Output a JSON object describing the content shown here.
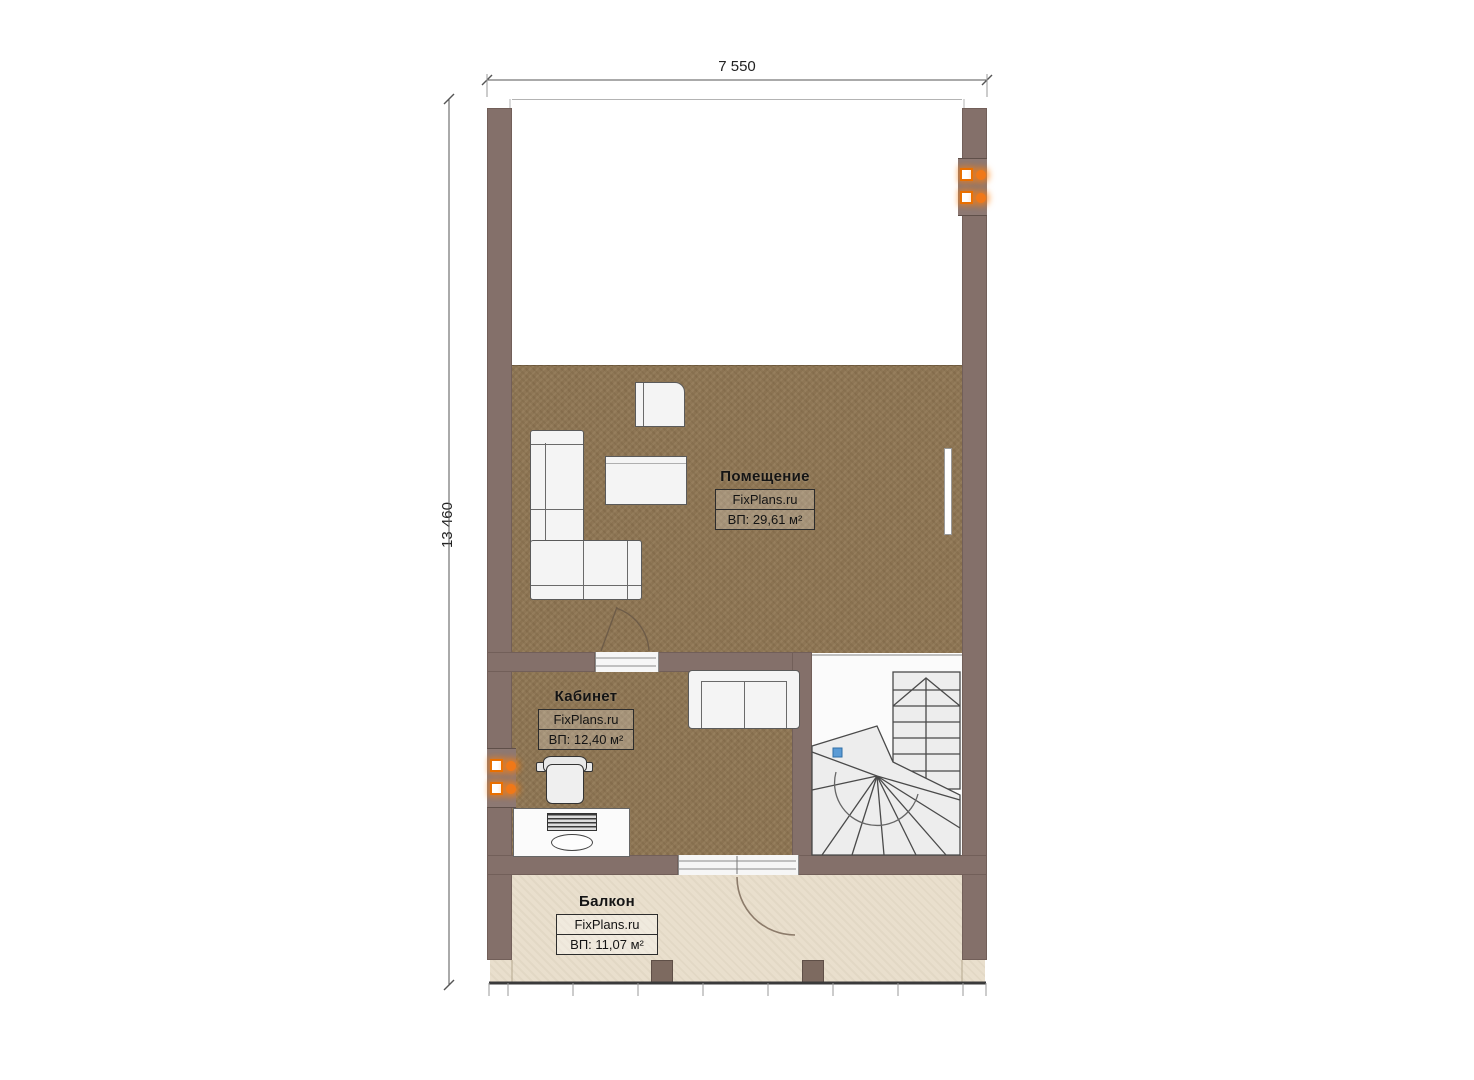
{
  "dimensions": {
    "width_label": "7 550",
    "height_label": "13 460"
  },
  "rooms": [
    {
      "name": "Помещение",
      "brand": "FixPlans.ru",
      "area": "ВП: 29,61 м²"
    },
    {
      "name": "Кабинет",
      "brand": "FixPlans.ru",
      "area": "ВП: 12,40 м²"
    },
    {
      "name": "Балкон",
      "brand": "FixPlans.ru",
      "area": "ВП: 11,07 м²"
    }
  ],
  "colors": {
    "wall": "#84706A",
    "floor": "#8E7655",
    "balcony_floor": "#E9DFCD",
    "stair_tread": "#EDEDED",
    "radiator_orange": "#F07818",
    "stair_marker_blue": "#5B9BD5"
  },
  "icons": {
    "radiator": "radiator-icon",
    "stair_marker": "stair-marker-icon"
  }
}
